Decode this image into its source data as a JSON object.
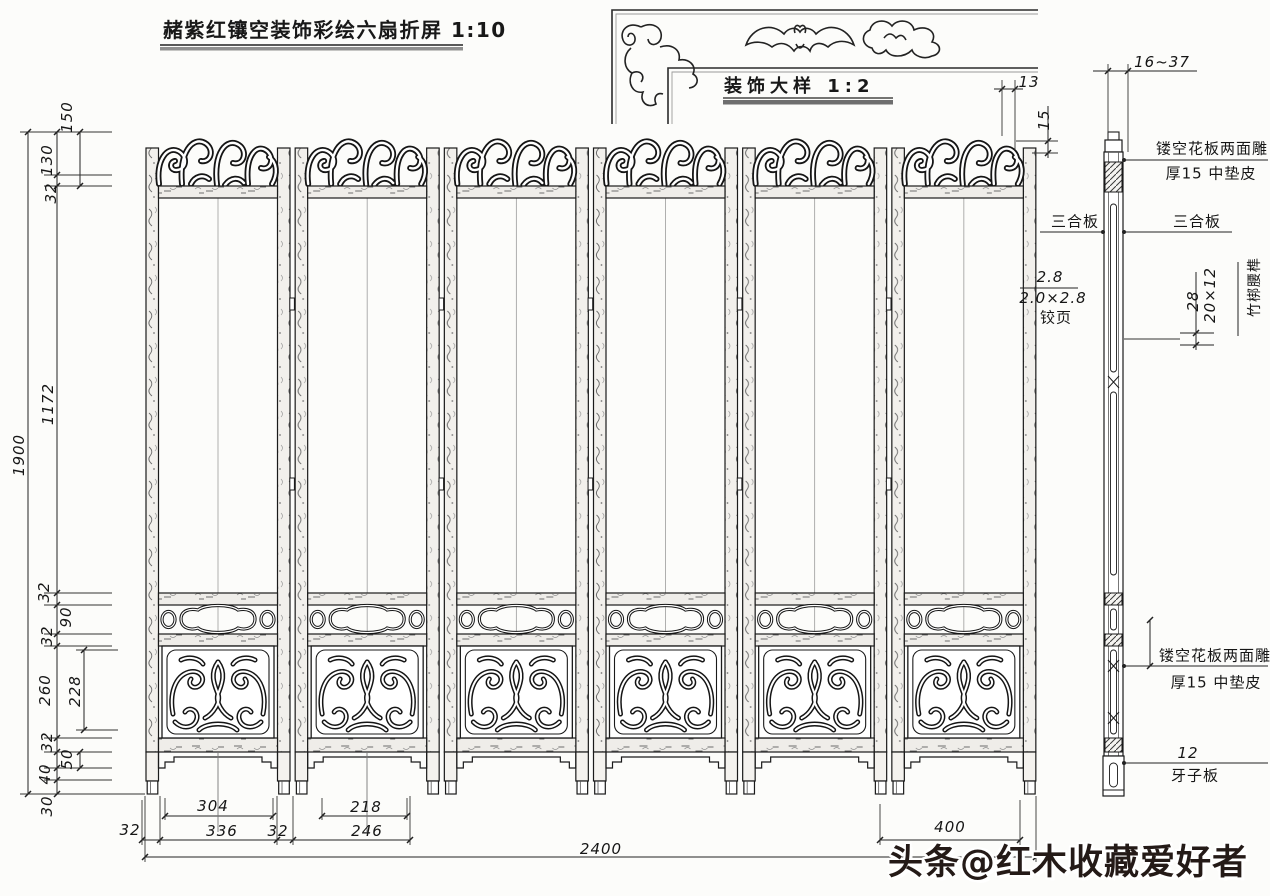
{
  "title": {
    "text": "赭紫红镶空装饰彩绘六扇折屏 1:10"
  },
  "detail": {
    "text": "装饰大样 1:2"
  },
  "watermark": {
    "text": "头条@红木收藏爱好者"
  },
  "drawing": {
    "type": "furniture technical drawing",
    "subject": "six-panel carved folding screen, front elevation with side section",
    "panel_count": 6,
    "main_scale": "1:10",
    "detail_scale": "1:2",
    "overall_width_mm": 2400,
    "overall_height_mm": 1900
  },
  "labels": [
    {
      "t": "13",
      "x": 1029,
      "y": 82,
      "cls": "num"
    },
    {
      "t": "15",
      "x": 1044,
      "y": 120,
      "cls": "numr"
    },
    {
      "t": "16~37",
      "x": 1162,
      "y": 62,
      "cls": "num"
    },
    {
      "t": "150",
      "x": 67,
      "y": 117,
      "cls": "numr"
    },
    {
      "t": "130",
      "x": 47,
      "y": 160,
      "cls": "numr"
    },
    {
      "t": "32",
      "x": 51,
      "y": 193,
      "cls": "numr"
    },
    {
      "t": "1172",
      "x": 48,
      "y": 404,
      "cls": "numr"
    },
    {
      "t": "1900",
      "x": 19,
      "y": 455,
      "cls": "numr"
    },
    {
      "t": "32",
      "x": 44,
      "y": 592,
      "cls": "numr"
    },
    {
      "t": "90",
      "x": 66,
      "y": 617,
      "cls": "numr"
    },
    {
      "t": "32",
      "x": 47,
      "y": 636,
      "cls": "numr"
    },
    {
      "t": "260",
      "x": 45,
      "y": 690,
      "cls": "numr"
    },
    {
      "t": "228",
      "x": 75,
      "y": 691,
      "cls": "numr"
    },
    {
      "t": "32",
      "x": 47,
      "y": 742,
      "cls": "numr"
    },
    {
      "t": "50",
      "x": 67,
      "y": 759,
      "cls": "numr"
    },
    {
      "t": "40",
      "x": 45,
      "y": 774,
      "cls": "numr"
    },
    {
      "t": "30",
      "x": 47,
      "y": 806,
      "cls": "numr"
    },
    {
      "t": "2.8",
      "x": 1050,
      "y": 277,
      "cls": "num"
    },
    {
      "t": "2.0×2.8",
      "x": 1053,
      "y": 298,
      "cls": "num"
    },
    {
      "t": "铰页",
      "x": 1056,
      "y": 317,
      "cls": "cjk"
    },
    {
      "t": "28",
      "x": 1193,
      "y": 301,
      "cls": "numr"
    },
    {
      "t": "20×12",
      "x": 1210,
      "y": 295,
      "cls": "numr"
    },
    {
      "t": "竹梆腰榫",
      "x": 1254,
      "y": 287,
      "cls": "cjkr"
    },
    {
      "t": "镂空花板两面雕",
      "x": 1212,
      "y": 148,
      "cls": "cjk"
    },
    {
      "t": "厚15 中垫皮",
      "x": 1211,
      "y": 173,
      "cls": "cjk"
    },
    {
      "t": "三合板",
      "x": 1075,
      "y": 221,
      "cls": "cjk"
    },
    {
      "t": "三合板",
      "x": 1197,
      "y": 221,
      "cls": "cjk"
    },
    {
      "t": "镂空花板两面雕",
      "x": 1215,
      "y": 655,
      "cls": "cjk"
    },
    {
      "t": "厚15 中垫皮",
      "x": 1216,
      "y": 682,
      "cls": "cjk"
    },
    {
      "t": "12",
      "x": 1188,
      "y": 753,
      "cls": "num"
    },
    {
      "t": "牙子板",
      "x": 1195,
      "y": 775,
      "cls": "cjk"
    },
    {
      "t": "304",
      "x": 213,
      "y": 806,
      "cls": "num"
    },
    {
      "t": "218",
      "x": 366,
      "y": 807,
      "cls": "num"
    },
    {
      "t": "32",
      "x": 130,
      "y": 830,
      "cls": "num"
    },
    {
      "t": "336",
      "x": 222,
      "y": 831,
      "cls": "num"
    },
    {
      "t": "32",
      "x": 278,
      "y": 831,
      "cls": "num"
    },
    {
      "t": "246",
      "x": 367,
      "y": 831,
      "cls": "num"
    },
    {
      "t": "400",
      "x": 950,
      "y": 827,
      "cls": "num"
    },
    {
      "t": "2400",
      "x": 601,
      "y": 849,
      "cls": "num"
    }
  ]
}
